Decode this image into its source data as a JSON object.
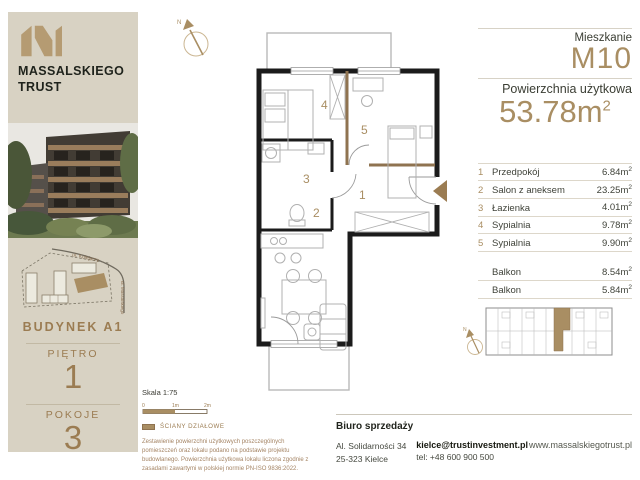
{
  "brand": {
    "line1": "MASSALSKIEGO",
    "line2": "TRUST"
  },
  "sidebar": {
    "building_label": "BUDYNEK A1",
    "floor_label": "PIĘTRO",
    "floor_value": "1",
    "rooms_label": "POKOJE",
    "rooms_value": "3",
    "streets": {
      "top": "ul. Kolejarzy",
      "right": "ul. Massalskiego"
    }
  },
  "apartment": {
    "unit_label": "Mieszkanie",
    "unit_number": "M10",
    "area_label": "Powierzchnia użytkowa",
    "area_value": "53.78",
    "rooms": [
      {
        "no": "1",
        "name": "Przedpokój",
        "area": "6.84"
      },
      {
        "no": "2",
        "name": "Salon z aneksem",
        "area": "23.25"
      },
      {
        "no": "3",
        "name": "Łazienka",
        "area": "4.01"
      },
      {
        "no": "4",
        "name": "Sypialnia",
        "area": "9.78"
      },
      {
        "no": "5",
        "name": "Sypialnia",
        "area": "9.90"
      }
    ],
    "balconies": [
      {
        "name": "Balkon",
        "area": "8.54"
      },
      {
        "name": "Balkon",
        "area": "5.84"
      }
    ]
  },
  "units": {
    "base": "m",
    "exp": "2"
  },
  "plan": {
    "scale_label": "Skala 1:75",
    "scale_ticks": [
      "0",
      "1m",
      "2m"
    ],
    "legend_partition_label": "ŚCIANY DZIAŁOWE",
    "compass_label": "N",
    "room_numbers": [
      "1",
      "2",
      "3",
      "4",
      "5"
    ],
    "disclaimer": "Zestawienie powierzchni użytkowych poszczególnych pomieszczeń oraz lokalu podano na podstawie projektu budowlanego. Powierzchnia użytkowa lokalu liczona zgodnie z zasadami zawartymi w polskiej normie PN-ISO 9836:2022."
  },
  "footer": {
    "office_label": "Biuro sprzedaży",
    "address_line1": "Al. Solidarności 34",
    "address_line2": "25-323 Kielce",
    "email": "kielce@trustinvestment.pl",
    "phone": "tel: +48 600 900 500",
    "website": "www.massalskiegotrust.pl"
  },
  "colors": {
    "accent": "#a98e63",
    "beige": "#d8d2c3",
    "dark_text": "#30332b",
    "wall": "#1b1b1b",
    "partition": "#8f7350"
  }
}
